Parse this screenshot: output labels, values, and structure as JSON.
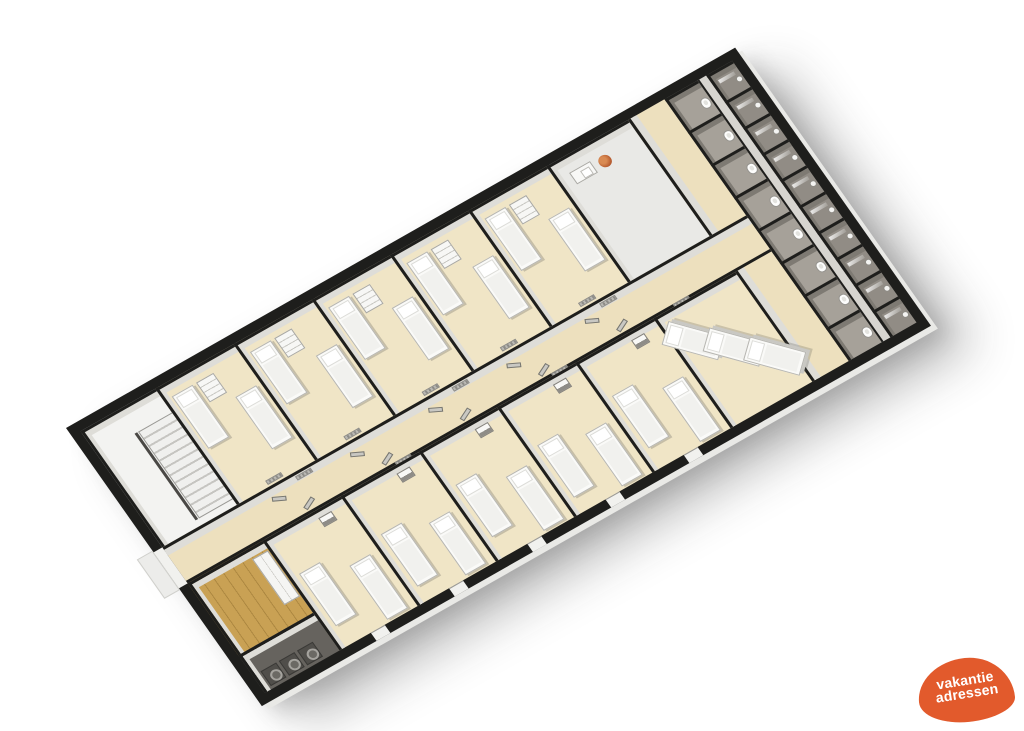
{
  "image": {
    "description": "3D isometric floor plan of a long group-accommodation building with bedrooms, dorm, corridor, stairwell, laundry and sanitary block",
    "background": "#ffffff"
  },
  "logo": {
    "line1": "vakantie",
    "line2": "adressen",
    "blob_color": "#e25a2c",
    "text_color": "#ffffff"
  },
  "palette": {
    "wall": "#1e1e1c",
    "wall_face": "#deddul8",
    "stall_face": "#7e7a73",
    "floor_bedroom": "#f0e5c6",
    "floor_corridor": "#ede0be",
    "floor_bathroom": "#e9e9e6",
    "floor_stairs": "#f3f3f1",
    "floor_stall": "#a6a199",
    "floor_stall_outer": "#918c85",
    "floor_aisle": "#d7d5d0",
    "floor_wood": "#c9a154",
    "floor_laundry": "#66635e",
    "furniture_white": "#fafaf8",
    "logo": "#e25a2c"
  },
  "floorplan": {
    "view": {
      "width": 770,
      "height": 340,
      "wall_thickness": 10
    },
    "rooms": [
      {
        "name": "stairwell",
        "floor": "floor_stairs",
        "x": 10,
        "y": 10,
        "w": 86,
        "h": 142,
        "items": [
          [
            "rail",
            40,
            26,
            3,
            106
          ],
          [
            "stairs",
            44,
            26,
            42,
            106
          ]
        ]
      },
      {
        "name": "bedroom-t1",
        "floor": "floor_bedroom",
        "x": 96,
        "y": 10,
        "w": 90,
        "h": 142,
        "items": [
          [
            "bed",
            6,
            12,
            24,
            64
          ],
          [
            "dresser",
            34,
            12,
            20,
            24
          ],
          [
            "bed",
            58,
            44,
            24,
            64
          ],
          [
            "radiator",
            34,
            132,
            18,
            5
          ]
        ]
      },
      {
        "name": "bedroom-t2",
        "floor": "floor_bedroom",
        "x": 186,
        "y": 10,
        "w": 90,
        "h": 142,
        "items": [
          [
            "bed",
            6,
            12,
            24,
            64
          ],
          [
            "dresser",
            34,
            12,
            20,
            24
          ],
          [
            "bed",
            58,
            48,
            24,
            64
          ],
          [
            "radiator",
            34,
            132,
            18,
            5
          ]
        ]
      },
      {
        "name": "bedroom-t3",
        "floor": "floor_bedroom",
        "x": 276,
        "y": 10,
        "w": 90,
        "h": 142,
        "items": [
          [
            "bed",
            6,
            12,
            24,
            64
          ],
          [
            "dresser",
            34,
            12,
            20,
            24
          ],
          [
            "bed",
            58,
            44,
            24,
            64
          ],
          [
            "radiator",
            34,
            132,
            18,
            5
          ]
        ]
      },
      {
        "name": "bedroom-t4",
        "floor": "floor_bedroom",
        "x": 366,
        "y": 10,
        "w": 90,
        "h": 142,
        "items": [
          [
            "bed",
            6,
            12,
            24,
            64
          ],
          [
            "dresser",
            34,
            12,
            20,
            24
          ],
          [
            "bed",
            58,
            48,
            24,
            64
          ],
          [
            "radiator",
            34,
            132,
            18,
            5
          ]
        ]
      },
      {
        "name": "bedroom-t5",
        "floor": "floor_bedroom",
        "x": 456,
        "y": 10,
        "w": 90,
        "h": 142,
        "items": [
          [
            "bed",
            6,
            12,
            24,
            64
          ],
          [
            "dresser",
            34,
            12,
            20,
            24
          ],
          [
            "bed",
            58,
            44,
            24,
            64
          ],
          [
            "radiator",
            34,
            132,
            18,
            5
          ]
        ]
      },
      {
        "name": "washroom",
        "floor": "floor_bathroom",
        "x": 546,
        "y": 10,
        "w": 94,
        "h": 142,
        "items": [
          [
            "counter",
            12,
            14,
            24,
            14
          ],
          [
            "plant",
            42,
            15,
            13,
            13
          ]
        ]
      },
      {
        "name": "hall-cross",
        "kind": "crosshall",
        "floor": "floor_corridor",
        "x": 640,
        "y": 10,
        "w": 42,
        "h": 320,
        "items": []
      },
      {
        "name": "wc-stall-1",
        "kind": "stall",
        "floor": "floor_stall",
        "x": 682,
        "y": 10,
        "w": 38,
        "h": 40,
        "items": [
          [
            "toilet",
            24,
            15,
            10,
            12
          ]
        ]
      },
      {
        "name": "wc-stall-2",
        "kind": "stall",
        "floor": "floor_stall",
        "x": 682,
        "y": 50,
        "w": 38,
        "h": 40,
        "items": [
          [
            "toilet",
            24,
            15,
            10,
            12
          ]
        ]
      },
      {
        "name": "wc-stall-3",
        "kind": "stall",
        "floor": "floor_stall",
        "x": 682,
        "y": 90,
        "w": 38,
        "h": 40,
        "items": [
          [
            "toilet",
            24,
            15,
            10,
            12
          ]
        ]
      },
      {
        "name": "wc-stall-4",
        "kind": "stall",
        "floor": "floor_stall",
        "x": 682,
        "y": 130,
        "w": 38,
        "h": 40,
        "items": [
          [
            "toilet",
            24,
            15,
            10,
            12
          ]
        ]
      },
      {
        "name": "wc-stall-5",
        "kind": "stall",
        "floor": "floor_stall",
        "x": 682,
        "y": 170,
        "w": 38,
        "h": 40,
        "items": [
          [
            "toilet",
            24,
            15,
            10,
            12
          ]
        ]
      },
      {
        "name": "wc-stall-6",
        "kind": "stall",
        "floor": "floor_stall",
        "x": 682,
        "y": 210,
        "w": 38,
        "h": 40,
        "items": [
          [
            "toilet",
            24,
            15,
            10,
            12
          ]
        ]
      },
      {
        "name": "wc-stall-7",
        "kind": "stall",
        "floor": "floor_stall",
        "x": 682,
        "y": 250,
        "w": 38,
        "h": 40,
        "items": [
          [
            "toilet",
            24,
            15,
            10,
            12
          ]
        ]
      },
      {
        "name": "wc-stall-8",
        "kind": "stall",
        "floor": "floor_stall",
        "x": 682,
        "y": 290,
        "w": 38,
        "h": 40,
        "items": [
          [
            "toilet",
            24,
            15,
            10,
            12
          ]
        ]
      },
      {
        "name": "sanitary-aisle",
        "kind": "aisle",
        "floor": "floor_aisle",
        "x": 720,
        "y": 10,
        "w": 10,
        "h": 320,
        "items": []
      },
      {
        "name": "shower-stall-1",
        "kind": "stall",
        "floor": "floor_stall_outer",
        "x": 730,
        "y": 10,
        "w": 30,
        "h": 32,
        "items": [
          [
            "glass",
            4,
            7,
            18,
            4
          ],
          [
            "showerhead",
            19,
            13,
            7,
            7
          ]
        ]
      },
      {
        "name": "shower-stall-2",
        "kind": "stall",
        "floor": "floor_stall_outer",
        "x": 730,
        "y": 42,
        "w": 30,
        "h": 32,
        "items": [
          [
            "glass",
            4,
            7,
            18,
            4
          ],
          [
            "showerhead",
            19,
            13,
            7,
            7
          ]
        ]
      },
      {
        "name": "shower-stall-3",
        "kind": "stall",
        "floor": "floor_stall_outer",
        "x": 730,
        "y": 74,
        "w": 30,
        "h": 32,
        "items": [
          [
            "glass",
            4,
            7,
            18,
            4
          ],
          [
            "showerhead",
            19,
            13,
            7,
            7
          ]
        ]
      },
      {
        "name": "shower-stall-4",
        "kind": "stall",
        "floor": "floor_stall_outer",
        "x": 730,
        "y": 106,
        "w": 30,
        "h": 32,
        "items": [
          [
            "glass",
            4,
            7,
            18,
            4
          ],
          [
            "showerhead",
            19,
            13,
            7,
            7
          ]
        ]
      },
      {
        "name": "shower-stall-5",
        "kind": "stall",
        "floor": "floor_stall_outer",
        "x": 730,
        "y": 138,
        "w": 30,
        "h": 32,
        "items": [
          [
            "glass",
            4,
            7,
            18,
            4
          ],
          [
            "showerhead",
            19,
            13,
            7,
            7
          ]
        ]
      },
      {
        "name": "shower-stall-6",
        "kind": "stall",
        "floor": "floor_stall_outer",
        "x": 730,
        "y": 170,
        "w": 30,
        "h": 32,
        "items": [
          [
            "glass",
            4,
            7,
            18,
            4
          ],
          [
            "showerhead",
            19,
            13,
            7,
            7
          ]
        ]
      },
      {
        "name": "shower-stall-7",
        "kind": "stall",
        "floor": "floor_stall_outer",
        "x": 730,
        "y": 202,
        "w": 30,
        "h": 32,
        "items": [
          [
            "glass",
            4,
            7,
            18,
            4
          ],
          [
            "showerhead",
            19,
            13,
            7,
            7
          ]
        ]
      },
      {
        "name": "shower-stall-8",
        "kind": "stall",
        "floor": "floor_stall_outer",
        "x": 730,
        "y": 234,
        "w": 30,
        "h": 32,
        "items": [
          [
            "glass",
            4,
            7,
            18,
            4
          ],
          [
            "showerhead",
            19,
            13,
            7,
            7
          ]
        ]
      },
      {
        "name": "shower-stall-9",
        "kind": "stall",
        "floor": "floor_stall_outer",
        "x": 730,
        "y": 266,
        "w": 30,
        "h": 32,
        "items": [
          [
            "glass",
            4,
            7,
            18,
            4
          ],
          [
            "showerhead",
            19,
            13,
            7,
            7
          ]
        ]
      },
      {
        "name": "shower-stall-10",
        "kind": "stall",
        "floor": "floor_stall_outer",
        "x": 730,
        "y": 298,
        "w": 30,
        "h": 32,
        "items": [
          [
            "glass",
            4,
            7,
            18,
            4
          ],
          [
            "showerhead",
            19,
            13,
            7,
            7
          ]
        ]
      },
      {
        "name": "corridor",
        "kind": "corridor",
        "floor": "floor_corridor",
        "x": 10,
        "y": 152,
        "w": 672,
        "h": 44,
        "items": [
          [
            "door",
            118,
            7,
            14,
            5,
            26
          ],
          [
            "radiator",
            150,
            1,
            18,
            5
          ],
          [
            "door",
            208,
            7,
            14,
            5,
            26
          ],
          [
            "radiator",
            330,
            1,
            18,
            5
          ],
          [
            "door",
            298,
            7,
            14,
            5,
            26
          ],
          [
            "door",
            388,
            7,
            14,
            5,
            26
          ],
          [
            "radiator",
            500,
            1,
            18,
            5
          ],
          [
            "door",
            478,
            7,
            14,
            5,
            26
          ],
          [
            "door",
            140,
            32,
            14,
            5,
            -26
          ],
          [
            "radiator",
            240,
            38,
            18,
            5
          ],
          [
            "door",
            230,
            32,
            14,
            5,
            -26
          ],
          [
            "door",
            320,
            32,
            14,
            5,
            -26
          ],
          [
            "radiator",
            420,
            38,
            18,
            5
          ],
          [
            "door",
            410,
            32,
            14,
            5,
            -26
          ],
          [
            "door",
            500,
            32,
            14,
            5,
            -26
          ],
          [
            "radiator",
            560,
            38,
            18,
            5
          ]
        ]
      },
      {
        "name": "entry-hall",
        "floor": "floor_wood",
        "x": 10,
        "y": 196,
        "w": 86,
        "h": 88,
        "items": [
          [
            "cabinet",
            64,
            8,
            18,
            56
          ]
        ]
      },
      {
        "name": "laundry",
        "floor": "floor_laundry",
        "x": 10,
        "y": 284,
        "w": 86,
        "h": 46,
        "items": [
          [
            "washer",
            6,
            22,
            18,
            18
          ],
          [
            "washer",
            27,
            22,
            18,
            18
          ],
          [
            "washer",
            48,
            22,
            18,
            18
          ]
        ]
      },
      {
        "name": "bedroom-b1",
        "floor": "floor_bedroom",
        "x": 96,
        "y": 196,
        "w": 90,
        "h": 134,
        "items": [
          [
            "sink",
            56,
            5,
            15,
            11
          ],
          [
            "bed",
            8,
            44,
            24,
            64
          ],
          [
            "bed",
            54,
            62,
            24,
            66
          ]
        ]
      },
      {
        "name": "bedroom-b2",
        "floor": "floor_bedroom",
        "x": 186,
        "y": 196,
        "w": 90,
        "h": 134,
        "items": [
          [
            "sink",
            56,
            5,
            15,
            11
          ],
          [
            "bed",
            8,
            50,
            24,
            64
          ],
          [
            "bed",
            54,
            64,
            24,
            64
          ]
        ]
      },
      {
        "name": "bedroom-b3",
        "floor": "floor_bedroom",
        "x": 276,
        "y": 196,
        "w": 90,
        "h": 134,
        "items": [
          [
            "sink",
            56,
            5,
            15,
            11
          ],
          [
            "bed",
            8,
            44,
            24,
            64
          ],
          [
            "bed",
            54,
            62,
            24,
            66
          ]
        ]
      },
      {
        "name": "bedroom-b4",
        "floor": "floor_bedroom",
        "x": 366,
        "y": 196,
        "w": 90,
        "h": 134,
        "items": [
          [
            "sink",
            56,
            5,
            15,
            11
          ],
          [
            "bed",
            8,
            50,
            24,
            64
          ],
          [
            "bed",
            54,
            64,
            24,
            64
          ]
        ]
      },
      {
        "name": "bedroom-b5",
        "floor": "floor_bedroom",
        "x": 456,
        "y": 196,
        "w": 90,
        "h": 134,
        "items": [
          [
            "sink",
            56,
            5,
            15,
            11
          ],
          [
            "bed",
            8,
            44,
            24,
            64
          ],
          [
            "bed",
            54,
            62,
            24,
            66
          ]
        ]
      },
      {
        "name": "dorm",
        "floor": "floor_bedroom",
        "x": 546,
        "y": 196,
        "w": 94,
        "h": 134,
        "items": [
          [
            "bunk",
            4,
            8,
            26,
            56,
            -42
          ],
          [
            "bunk",
            34,
            34,
            26,
            56,
            -42
          ],
          [
            "bunk",
            62,
            62,
            26,
            56,
            -42
          ]
        ]
      }
    ],
    "openings": {
      "bottom_wall": [
        132,
        222,
        312,
        402,
        492
      ],
      "left_wall_at": 152,
      "left_wall_len": 44
    }
  }
}
